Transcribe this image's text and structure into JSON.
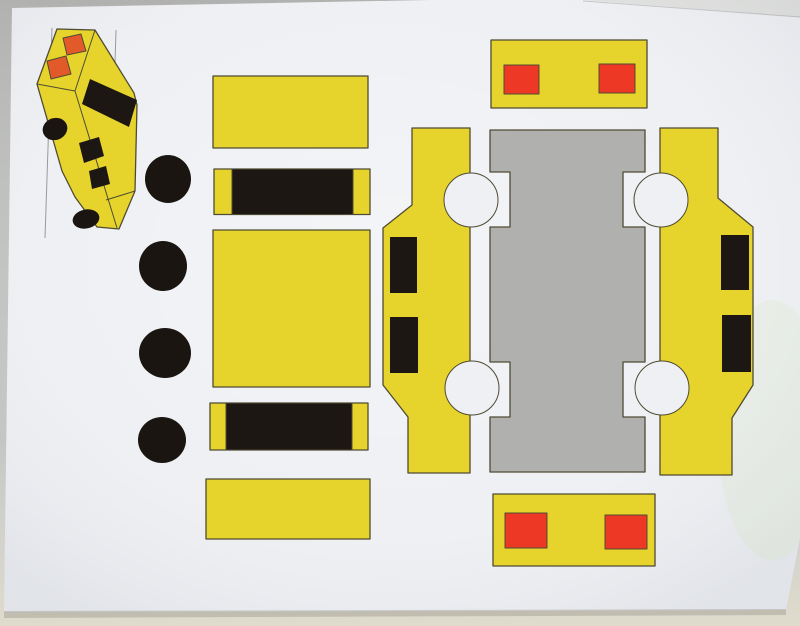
{
  "meta": {
    "scene": "photograph of a printed papercraft sheet lying on a table",
    "model": "yellow taxi-style car cut-out template with assembled-car preview drawing"
  },
  "colors": {
    "table": "#c5c6c4",
    "table_corner_sheet": "#dcddd9",
    "paper": "#edeff3",
    "outline": "#4f4b33",
    "yellow": "#e6d42d",
    "black": "#1d1713",
    "wheel_black": "#1a1511",
    "gray_panel": "#b0b0ae",
    "red_light": "#ed3826",
    "headlight_orange": "#e25a2a",
    "guide_line": "#999999",
    "cutout_white": "#eef0f3"
  },
  "inventory": {
    "assembled_car_preview": {
      "headlights": 2,
      "windshield_band": 1,
      "side_windows": 2,
      "wheels_visible": 2,
      "guide_lines": 2
    },
    "wheel_discs_count": 4,
    "plain_yellow_pieces_count": 3,
    "window_band_strips_count": 2,
    "side_panels_count": 2,
    "side_panel_windows_each": 2,
    "center_gray_panel_count": 1,
    "wheel_arch_cutouts_count": 4,
    "bumper_panels_count": 2,
    "bumper_lights_each": 2
  }
}
